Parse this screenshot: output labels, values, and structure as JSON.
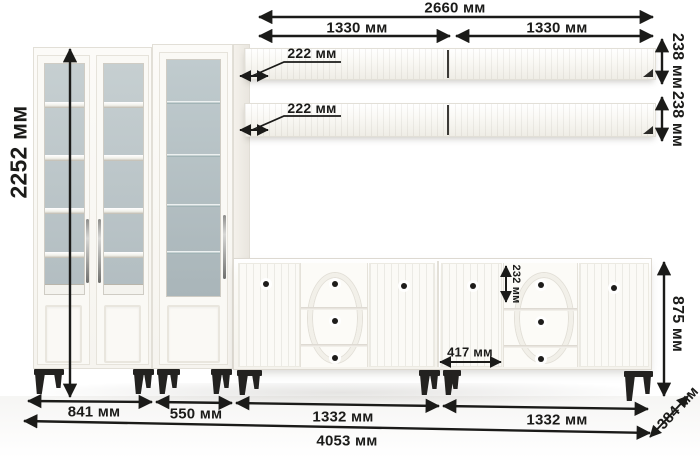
{
  "annotations": {
    "top_total_width": "2660 мм",
    "shelf_width_left": "1330 мм",
    "shelf_width_right": "1330 мм",
    "shelf1_height": "238 мм",
    "shelf2_height": "238 мм",
    "shelf1_depth": "222 мм",
    "shelf2_depth": "222 мм",
    "total_height": "2252 мм",
    "sideboard_height": "875 мм",
    "drawer_height": "232 мм",
    "door_width": "417 мм",
    "cabinet_double_width": "841 мм",
    "cabinet_single_width": "550 мм",
    "sideboard_left_width": "1332 мм",
    "sideboard_right_width": "1332 мм",
    "bottom_total_width": "4053 мм",
    "depth": "384 мм"
  },
  "colors": {
    "dimension_ink": "#1b1b19",
    "furniture_white": "#fbfaf7",
    "glass_interior": "#bcc6c9",
    "legs": "#232220"
  }
}
